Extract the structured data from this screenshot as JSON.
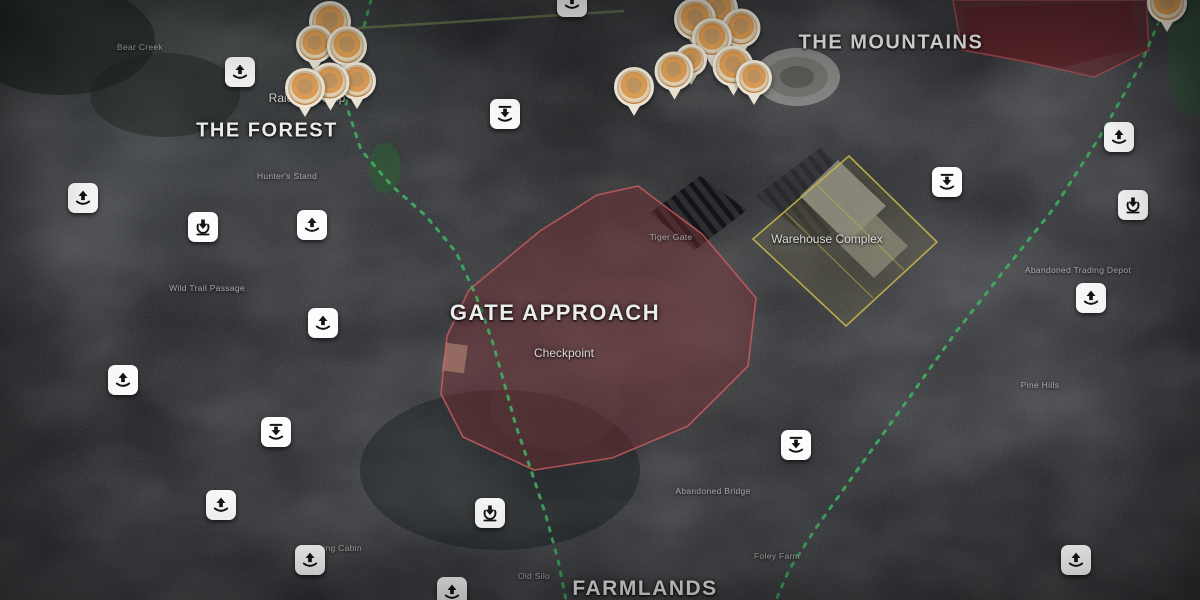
{
  "map": {
    "region_labels": [
      {
        "text": "THE FOREST",
        "x": 267,
        "y": 131,
        "size": 20
      },
      {
        "text": "THE MOUNTAINS",
        "x": 891,
        "y": 43,
        "size": 20
      },
      {
        "text": "GATE APPROACH",
        "x": 555,
        "y": 313,
        "size": 22
      },
      {
        "text": "FARMLANDS",
        "x": 645,
        "y": 589,
        "size": 21
      }
    ],
    "area_labels": [
      {
        "text": "Raiders Camp",
        "x": 307,
        "y": 98
      },
      {
        "text": "Warehouse Complex",
        "x": 827,
        "y": 239
      },
      {
        "text": "Checkpoint",
        "x": 564,
        "y": 353
      }
    ],
    "place_labels": [
      {
        "text": "Bear Creek",
        "x": 140,
        "y": 47
      },
      {
        "text": "Hunter's Stand",
        "x": 287,
        "y": 176
      },
      {
        "text": "Wild Trail Passage",
        "x": 207,
        "y": 288
      },
      {
        "text": "Tiger Gate",
        "x": 671,
        "y": 237
      },
      {
        "text": "Abandoned Trading Depot",
        "x": 1078,
        "y": 270
      },
      {
        "text": "Abandoned Bridge",
        "x": 713,
        "y": 491
      },
      {
        "text": "Hunting Cabin",
        "x": 333,
        "y": 548
      },
      {
        "text": "Old Silo",
        "x": 534,
        "y": 576
      },
      {
        "text": "Foley Farm",
        "x": 777,
        "y": 556
      },
      {
        "text": "Pine Hills",
        "x": 1040,
        "y": 385
      }
    ],
    "zones": [
      {
        "name": "gate-approach-zone",
        "points": "638,186 702,234 756,298 748,366 688,426 612,458 534,470 463,437 441,394 447,336 469,290 540,231 597,195",
        "fill": "rgba(128,44,50,0.40)",
        "stroke": "rgba(205,95,95,0.8)"
      },
      {
        "name": "warehouse-complex-zone",
        "points": "849,156 937,242 846,326 753,239",
        "fill": "rgba(210,190,80,0.10)",
        "stroke": "rgba(196,180,76,0.9)",
        "inner_lines": [
          [
            785,
            212,
            873,
            298
          ],
          [
            816,
            184,
            904,
            270
          ]
        ]
      },
      {
        "name": "mountain-compound-zone",
        "points": "953,0 1146,0 1149,50 1094,77 1028,62 962,50",
        "fill": "rgba(112,30,36,0.5)",
        "stroke": "rgba(190,85,90,0.65)"
      }
    ],
    "paths": [
      {
        "name": "western-route",
        "points": "371,0 357,52 346,104 361,150 392,186 426,216 456,252 476,296 492,340 505,386 516,426 531,470 546,516 558,560 566,600",
        "color": "#3fae5e"
      },
      {
        "name": "eastern-route",
        "points": "1168,0 1140,66 1099,138 1054,208 1003,272 956,332 909,398 863,462 816,528 789,570 776,600",
        "color": "#3fae5e"
      }
    ],
    "icons": [
      {
        "type": "upload",
        "x": 240,
        "y": 72
      },
      {
        "type": "upload",
        "x": 572,
        "y": 2
      },
      {
        "type": "upload",
        "x": 83,
        "y": 198
      },
      {
        "type": "upload",
        "x": 312,
        "y": 225
      },
      {
        "type": "upload",
        "x": 323,
        "y": 323
      },
      {
        "type": "upload",
        "x": 123,
        "y": 380
      },
      {
        "type": "upload",
        "x": 221,
        "y": 505
      },
      {
        "type": "upload",
        "x": 310,
        "y": 560
      },
      {
        "type": "upload",
        "x": 452,
        "y": 592
      },
      {
        "type": "upload",
        "x": 1119,
        "y": 137
      },
      {
        "type": "upload",
        "x": 1091,
        "y": 298
      },
      {
        "type": "upload",
        "x": 1076,
        "y": 560
      },
      {
        "type": "download",
        "x": 203,
        "y": 227
      },
      {
        "type": "download",
        "x": 490,
        "y": 513
      },
      {
        "type": "download",
        "x": 1133,
        "y": 205
      },
      {
        "type": "download-tray",
        "x": 505,
        "y": 114
      },
      {
        "type": "download-tray",
        "x": 947,
        "y": 182
      },
      {
        "type": "download-tray",
        "x": 796,
        "y": 445
      },
      {
        "type": "download-tray",
        "x": 276,
        "y": 432
      }
    ],
    "marker_clusters": [
      {
        "name": "raiders-camp-cluster",
        "pins": [
          {
            "x": 330,
            "y": 22,
            "s": 36
          },
          {
            "x": 315,
            "y": 44,
            "s": 32
          },
          {
            "x": 347,
            "y": 46,
            "s": 34
          },
          {
            "x": 305,
            "y": 88,
            "s": 34
          },
          {
            "x": 330,
            "y": 82,
            "s": 33
          },
          {
            "x": 357,
            "y": 81,
            "s": 32
          }
        ]
      },
      {
        "name": "mountains-cluster",
        "pins": [
          {
            "x": 718,
            "y": 9,
            "s": 34
          },
          {
            "x": 695,
            "y": 19,
            "s": 36
          },
          {
            "x": 741,
            "y": 28,
            "s": 33
          },
          {
            "x": 712,
            "y": 38,
            "s": 34
          },
          {
            "x": 691,
            "y": 60,
            "s": 26
          },
          {
            "x": 733,
            "y": 66,
            "s": 35
          },
          {
            "x": 674,
            "y": 71,
            "s": 33
          },
          {
            "x": 754,
            "y": 78,
            "s": 30
          },
          {
            "x": 634,
            "y": 87,
            "s": 34
          }
        ]
      },
      {
        "name": "northeast-single",
        "pins": [
          {
            "x": 1167,
            "y": 3,
            "s": 34
          }
        ]
      }
    ],
    "colors": {
      "route_green": "#3fae5e",
      "zone_red": "#c05f5f",
      "zone_yellow": "#c4b44c",
      "pin_orange": "#e0a058",
      "icon_background": "#ffffff"
    }
  }
}
